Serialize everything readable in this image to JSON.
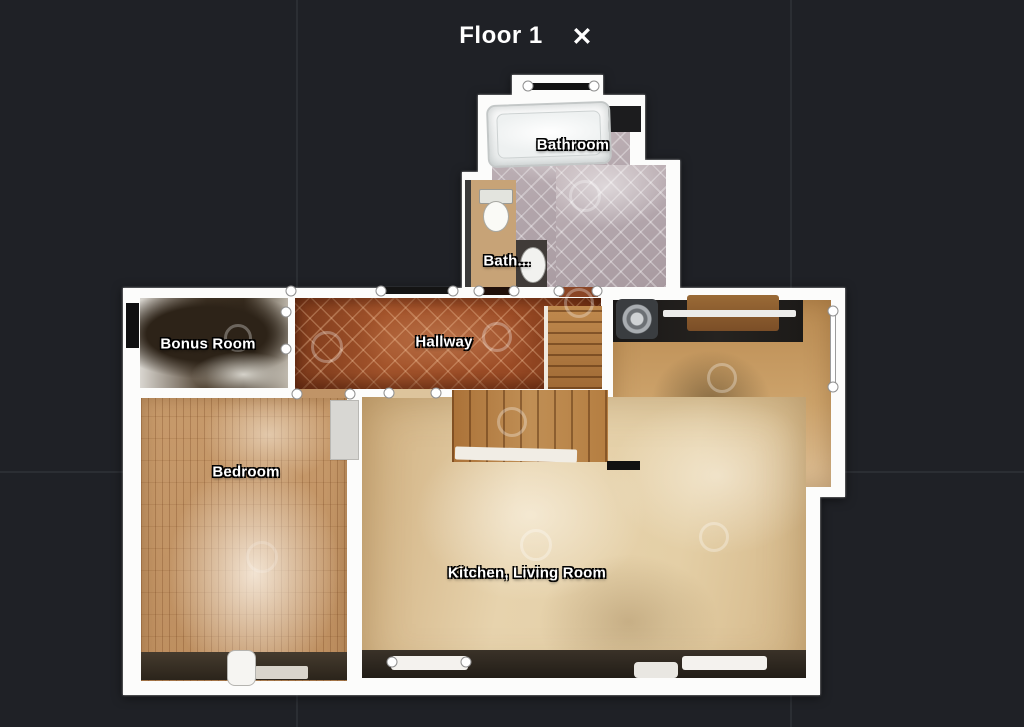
{
  "header": {
    "title": "Floor 1",
    "close_glyph": "✕"
  },
  "rooms": [
    {
      "id": "bathroom",
      "label": "Bathroom"
    },
    {
      "id": "bath-small",
      "label": "Bath..."
    },
    {
      "id": "bonus-room",
      "label": "Bonus Room"
    },
    {
      "id": "hallway",
      "label": "Hallway"
    },
    {
      "id": "bedroom",
      "label": "Bedroom"
    },
    {
      "id": "kitchen-living-room",
      "label": "Kitchen, Living Room"
    }
  ],
  "colors": {
    "background": "#1f2126",
    "wall": "#fcfcfb",
    "hallway_tile": "#9c4c26",
    "bathroom_tile": "#b2a5ab",
    "bedroom_floor": "#c79a6b",
    "living_floor": "#e4cfa6",
    "label_text": "#ffffff"
  }
}
